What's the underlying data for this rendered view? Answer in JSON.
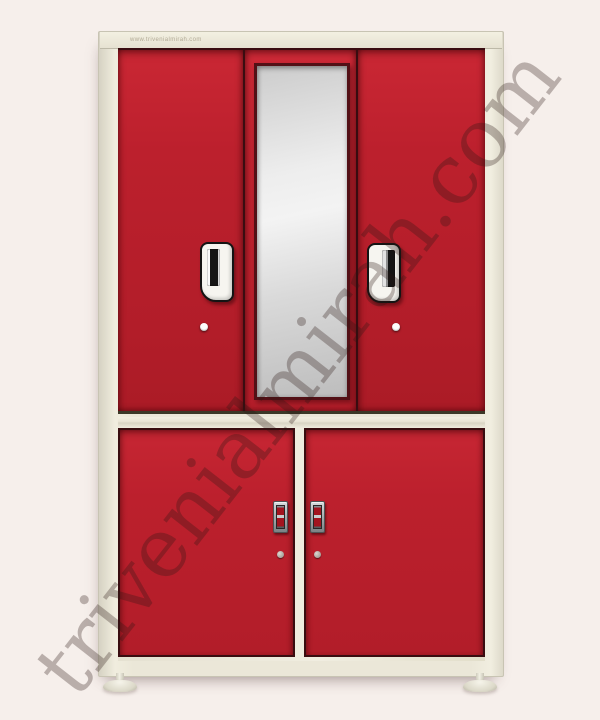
{
  "page": {
    "background_color": "#f6efeb"
  },
  "watermark": {
    "text": "trivenialmirah.com",
    "angle_deg": -52,
    "color": "rgba(43,22,20,0.30)"
  },
  "cabinet": {
    "website_label": "www.trivenialmirah.com",
    "colors": {
      "page_bg": "#f6efeb",
      "frame_cream": "#ebe7d8",
      "door_red": "#bc202d",
      "door_red_bright": "#c82734",
      "seam_dark": "#3a0d11",
      "mirror_silver": "#dedede",
      "handle_white": "#f6f5f0",
      "lock_metal": "#a2a8ab",
      "lock_red": "#a3141f"
    },
    "structure": {
      "upper_doors": 3,
      "lower_doors": 2,
      "mirror": "full-length center mirror",
      "upper_handles": 2,
      "lower_locks": 2,
      "feet": 2
    }
  }
}
